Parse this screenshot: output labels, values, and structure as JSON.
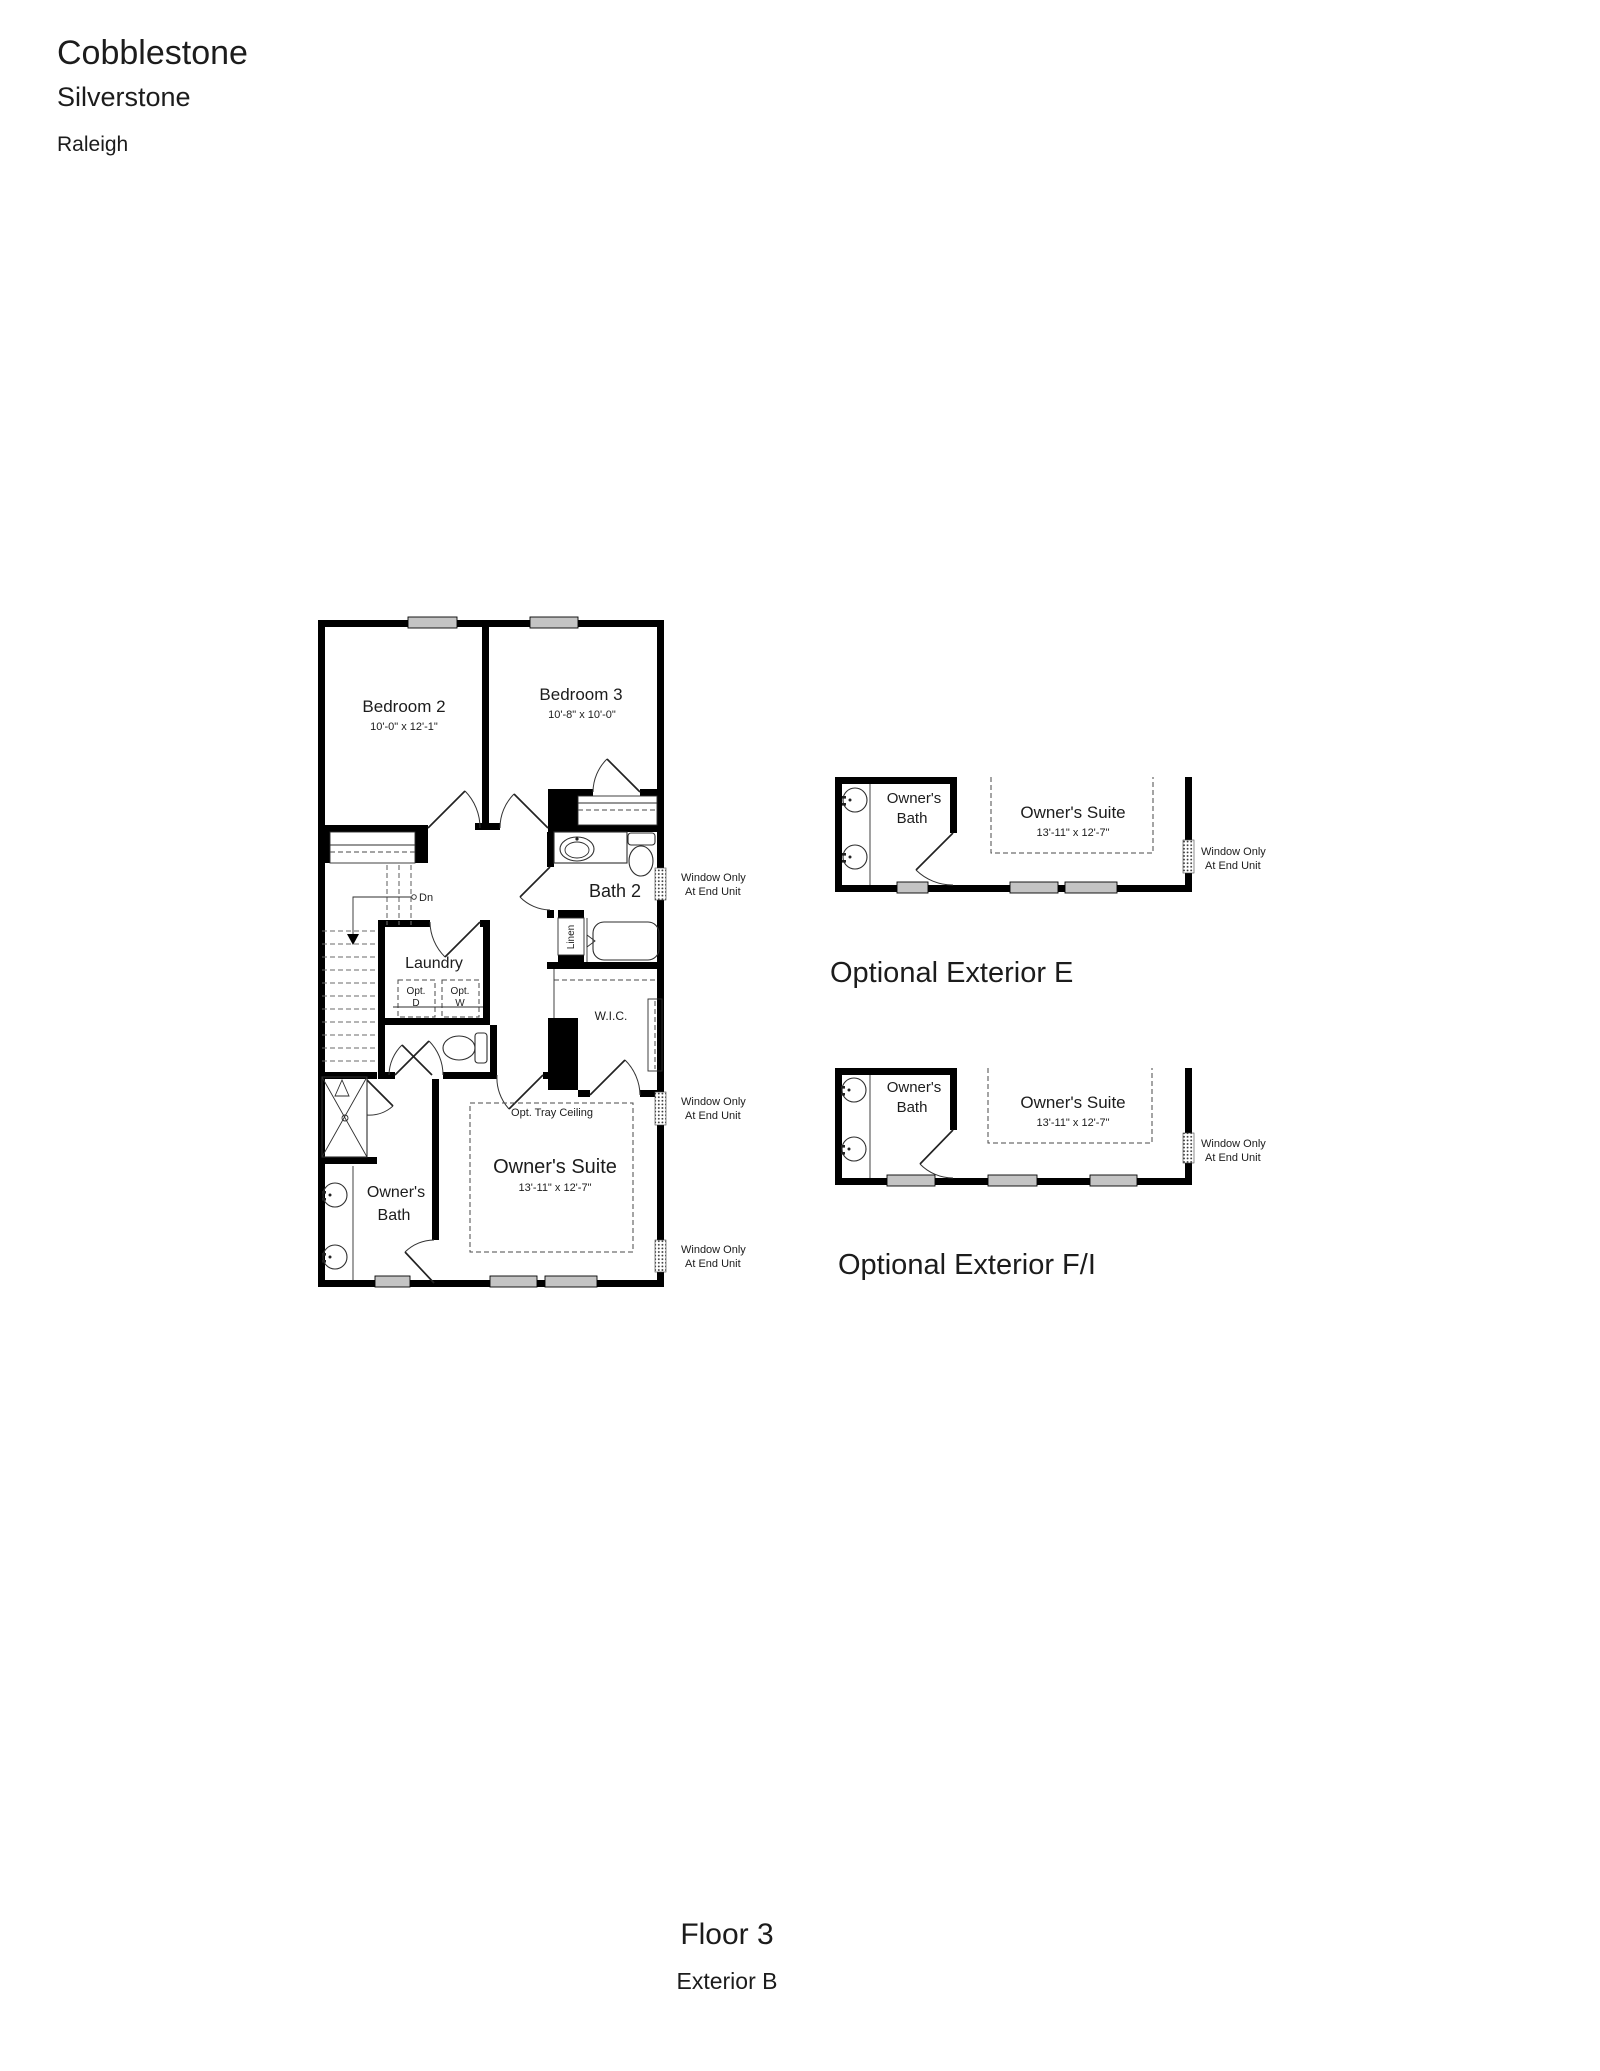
{
  "header": {
    "community": "Cobblestone",
    "neighborhood": "Silverstone",
    "city": "Raleigh"
  },
  "footer": {
    "floor_label": "Floor 3",
    "exterior_label": "Exterior B"
  },
  "colors": {
    "wall": "#000000",
    "window_fill": "#c4c4c4",
    "ink": "#1c1c1c"
  },
  "main_plan": {
    "rooms": {
      "bedroom2": {
        "name": "Bedroom 2",
        "dims": "10'-0\" x 12'-1\""
      },
      "bedroom3": {
        "name": "Bedroom 3",
        "dims": "10'-8\" x 10'-0\""
      },
      "bath2": {
        "name": "Bath 2"
      },
      "laundry": {
        "name": "Laundry"
      },
      "wic": {
        "name": "W.I.C."
      },
      "owners_suite": {
        "name": "Owner's Suite",
        "dims": "13'-11\" x 12'-7\"",
        "opt": "Opt. Tray Ceiling"
      },
      "owners_bath": {
        "line1": "Owner's",
        "line2": "Bath"
      },
      "linen": {
        "name": "Linen"
      }
    },
    "labels": {
      "dn": "Dn",
      "opt_d_line1": "Opt.",
      "opt_d_line2": "D",
      "opt_w_line1": "Opt.",
      "opt_w_line2": "W"
    },
    "window_note": {
      "line1": "Window Only",
      "line2": "At End Unit"
    }
  },
  "optional_e": {
    "caption": "Optional Exterior E",
    "owners_bath": {
      "line1": "Owner's",
      "line2": "Bath"
    },
    "owners_suite": {
      "name": "Owner's Suite",
      "dims": "13'-11\" x 12'-7\""
    },
    "window_note": {
      "line1": "Window Only",
      "line2": "At End Unit"
    }
  },
  "optional_fi": {
    "caption": "Optional Exterior F/I",
    "owners_bath": {
      "line1": "Owner's",
      "line2": "Bath"
    },
    "owners_suite": {
      "name": "Owner's Suite",
      "dims": "13'-11\" x 12'-7\""
    },
    "window_note": {
      "line1": "Window Only",
      "line2": "At End Unit"
    }
  }
}
